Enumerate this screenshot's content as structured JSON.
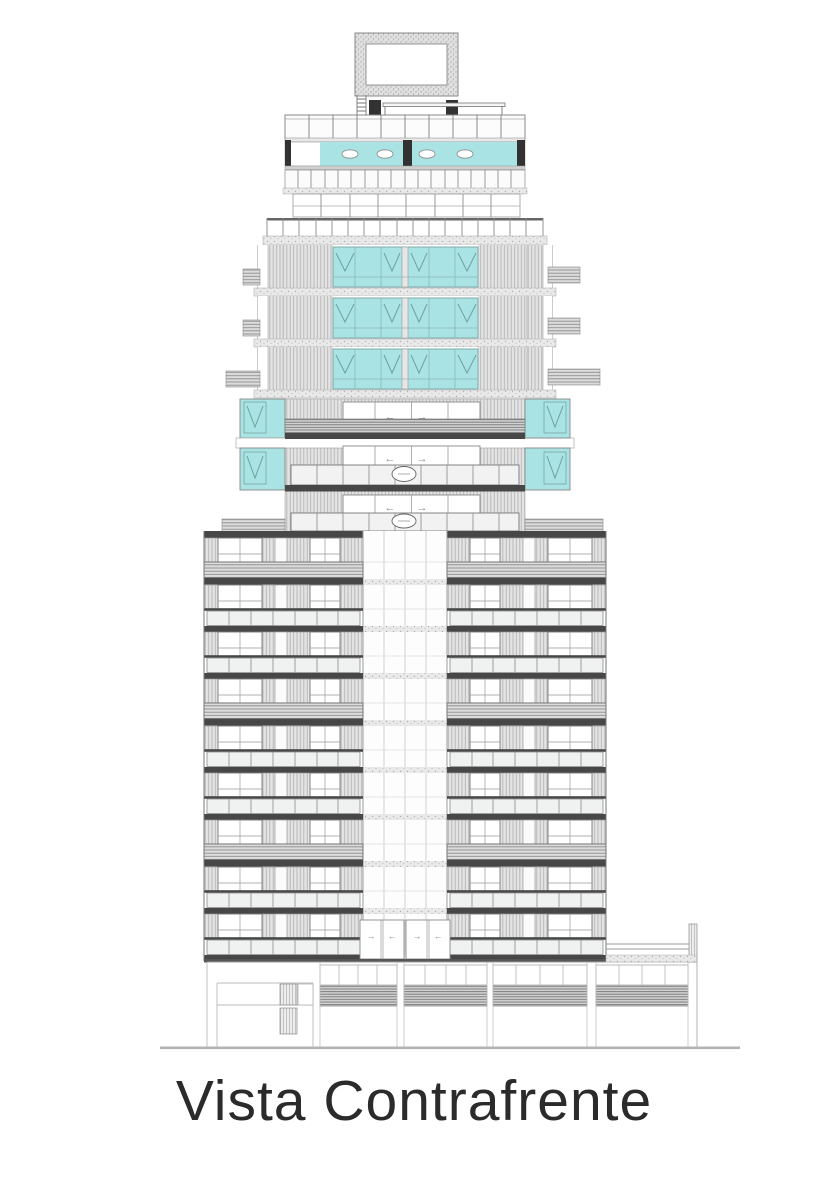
{
  "page": {
    "background": "#ffffff"
  },
  "title": {
    "text": "Vista Contrafrente"
  },
  "drawing": {
    "type": "architectural-elevation",
    "subject": "residential tower, rear elevation",
    "arrows": {
      "left": "←",
      "right": "→"
    },
    "colors": {
      "background": "#ffffff",
      "glass": "#a9e3e3",
      "glass_frame": "#7fa9a9",
      "slab": "#474747",
      "dark_post": "#323232",
      "line": "#8a8a8a",
      "ground": "#b3b3b3",
      "title_text": "#2b2b2b"
    },
    "counts": {
      "tower_floor_rows": 9,
      "pergola_bands": 3,
      "upper_glass_floors": 3,
      "setback_levels": 3,
      "pool_ovals": 4,
      "podium_louver_sections": 4
    }
  }
}
